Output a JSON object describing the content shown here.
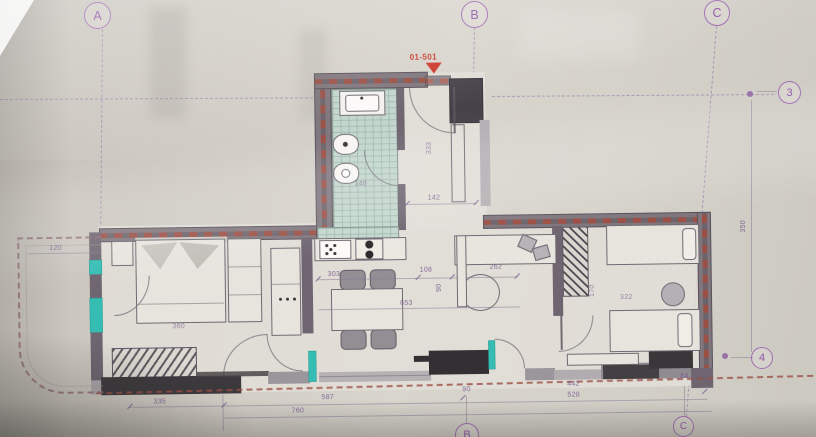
{
  "marker": {
    "label": "01-501"
  },
  "bubbles": {
    "a_top": "A",
    "b_top": "B",
    "c_top": "C",
    "r3": "3",
    "r4": "4",
    "b_bot": "B",
    "c_bot": "C"
  },
  "dims": {
    "balcony": "120",
    "bed": "360",
    "k303": "303",
    "k108": "108",
    "k262": "262",
    "k653": "653",
    "k90": "90",
    "bath": "148",
    "entry_w": "142",
    "entry_h": "333",
    "bed2_w": "322",
    "bed2_h": "170",
    "right_v": "350",
    "b335": "335",
    "b587": "587",
    "b760": "760",
    "b90": "90",
    "b442": "442",
    "b528": "528",
    "b84": "84"
  },
  "colors": {
    "grid": "#9c82ae",
    "wall_hatch": "#9c4f44",
    "marker_red": "#cc372a",
    "window_teal": "#35bdb4"
  }
}
